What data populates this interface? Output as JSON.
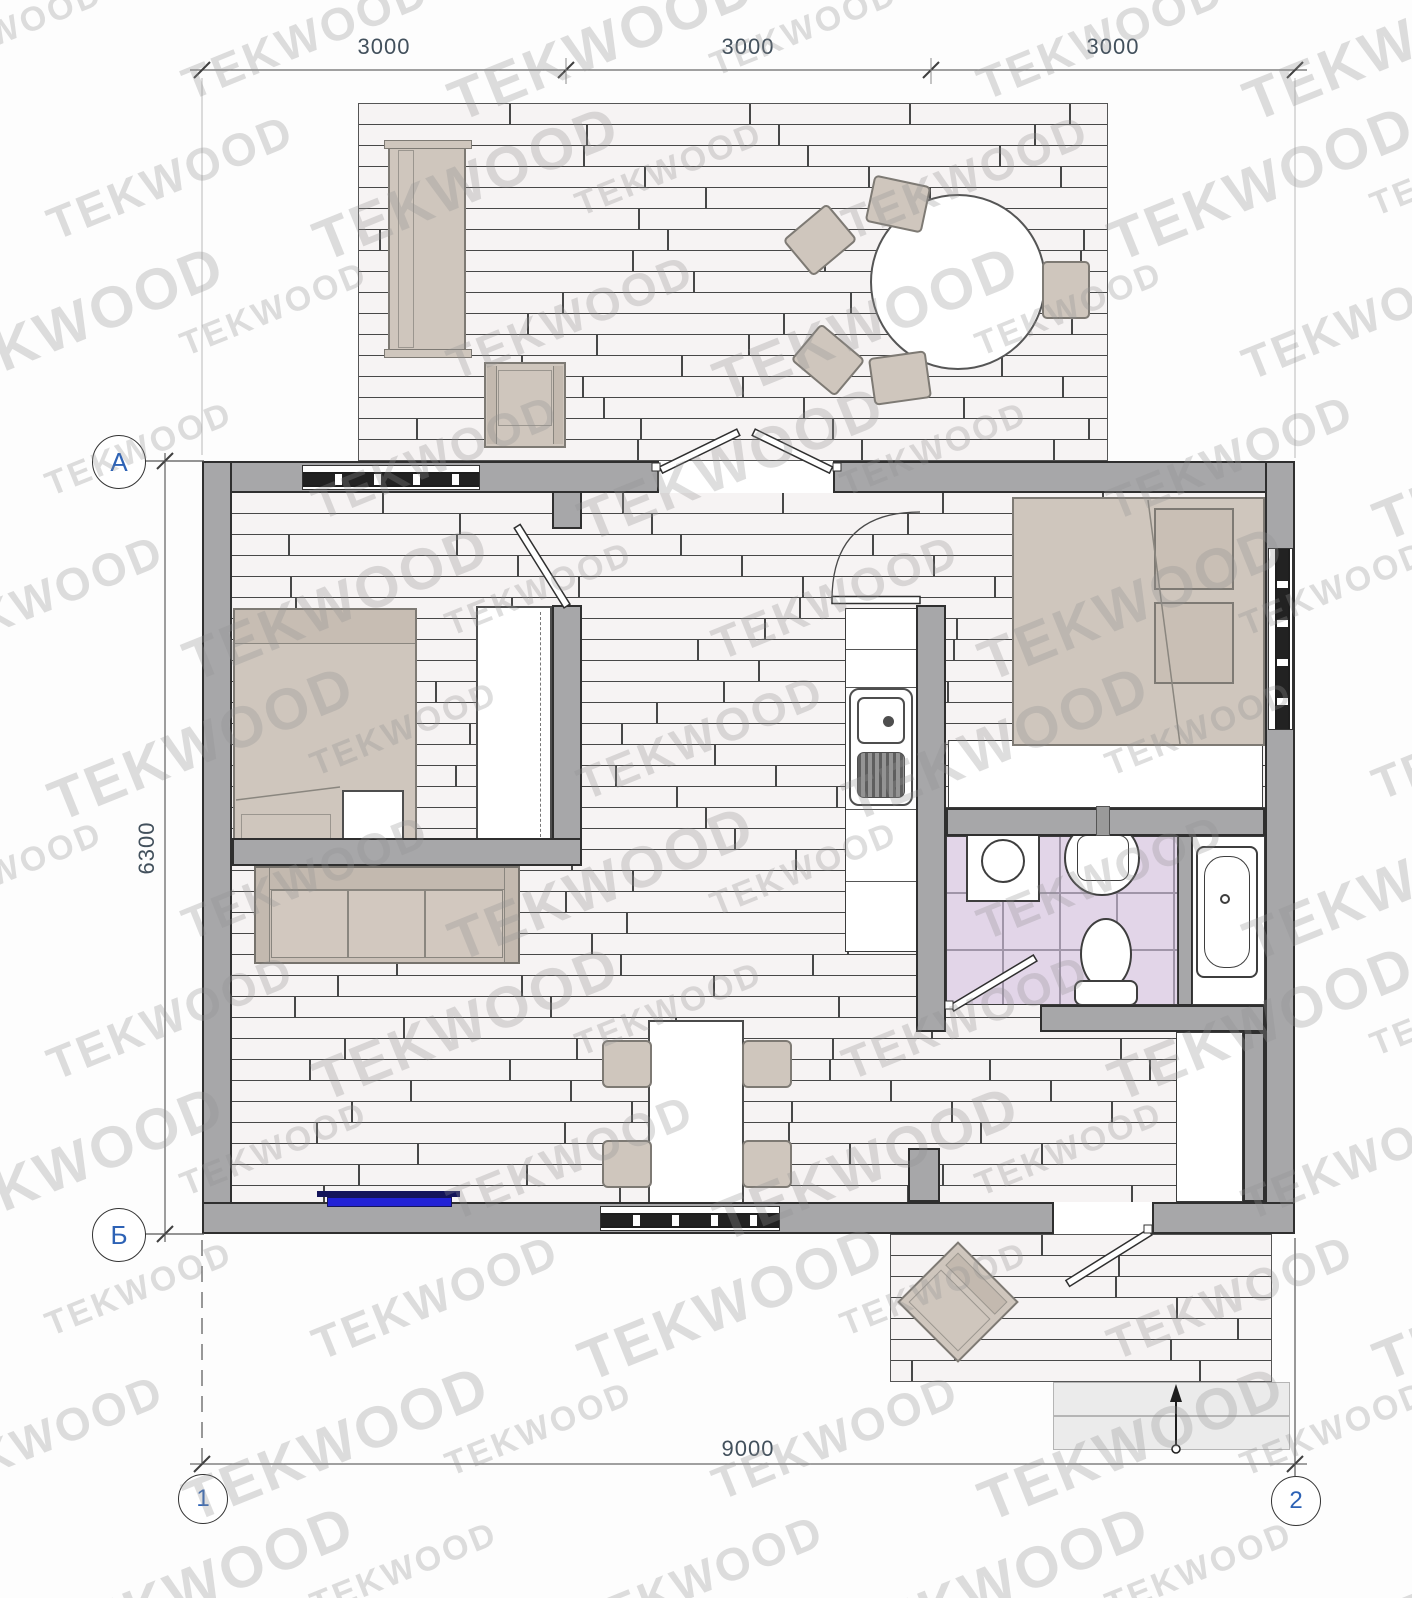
{
  "watermark": {
    "text": "TEKWOOD"
  },
  "dimensions": {
    "top_segments": [
      "3000",
      "3000",
      "3000"
    ],
    "left_total": "6300",
    "bottom_total": "9000"
  },
  "axes": {
    "row_top": "А",
    "row_bottom": "Б",
    "col_left": "1",
    "col_right": "2"
  },
  "colors": {
    "wall": "#a7a7a9",
    "wall-edge": "#2f2f2f",
    "plank": "#f6f3f3",
    "plank-joint": "#474747",
    "furniture": "#cfc6bd",
    "furniture-edge": "#7e7a74",
    "tile": "#e2d5e8",
    "tile-line": "#a095a8",
    "radiator": "#2121d6",
    "radiator-edge": "#14145a",
    "axis-label": "#2d62b5",
    "dim-text": "#42505c"
  }
}
